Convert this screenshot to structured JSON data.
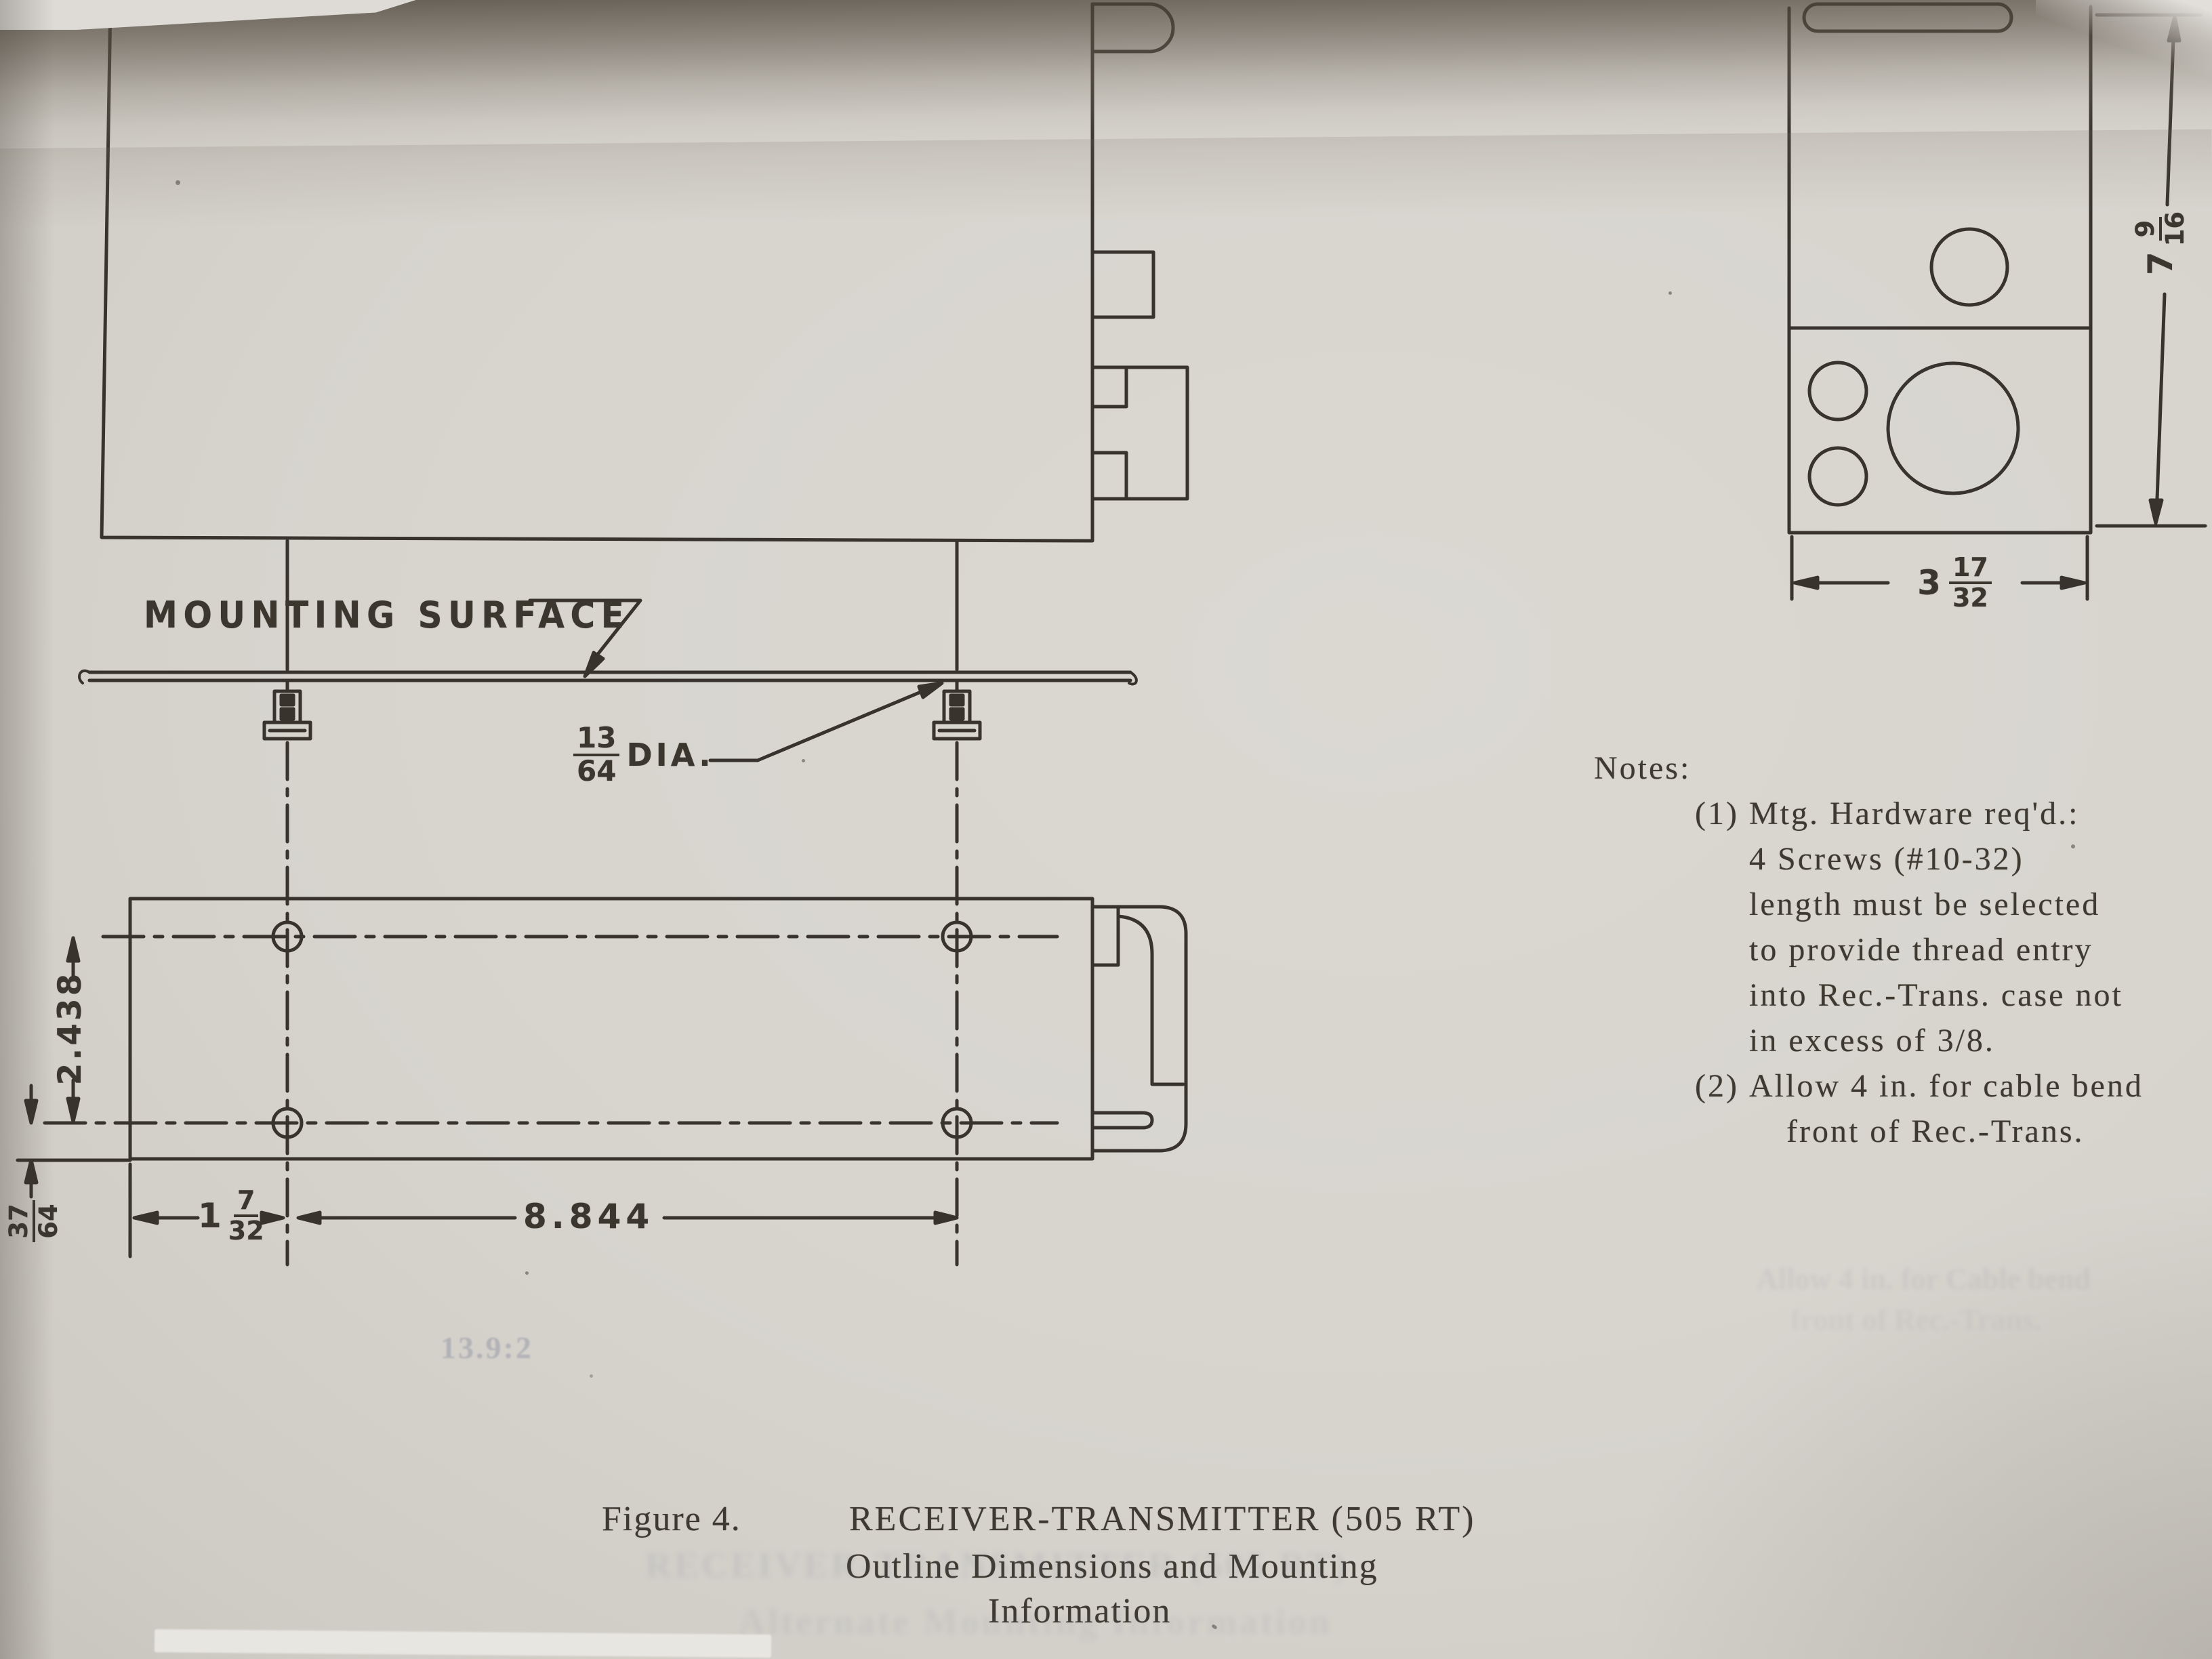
{
  "colors": {
    "paper": "#d7d4ce",
    "ink": "#38342d",
    "shadow": "#5e574c",
    "ghost_ink": "#7d849b"
  },
  "drawing": {
    "mounting_surface_label": "MOUNTING SURFACE",
    "dia": {
      "num": "13",
      "den": "64",
      "suffix": "DIA."
    },
    "dim_hole_row_spacing": "2.438",
    "dim_edge_offset": {
      "num": "37",
      "den": "64"
    },
    "dim_left_hole_offset": {
      "whole": "1",
      "num": "7",
      "den": "32"
    },
    "dim_hole_span": "8.844",
    "front_height": {
      "whole": "7",
      "num": "9",
      "den": "16"
    },
    "front_width": {
      "whole": "3",
      "num": "17",
      "den": "32"
    }
  },
  "notes": {
    "heading": "Notes:",
    "item1_no": "(1)",
    "item1_lines": [
      "Mtg. Hardware req'd.:",
      "4 Screws (#10-32)",
      "length must be selected",
      "to provide thread entry",
      "into Rec.-Trans. case not",
      "in excess of 3/8."
    ],
    "item2_no": "(2)",
    "item2_lines": [
      "Allow 4 in. for cable bend",
      "front of Rec.-Trans."
    ]
  },
  "caption": {
    "figure_label": "Figure 4.",
    "title": "RECEIVER-TRANSMITTER (505 RT)",
    "subtitle_line1": "Outline Dimensions and Mounting",
    "subtitle_line2": "Information"
  },
  "ghost": {
    "page_ref": "13.9:2",
    "caption_echo1": "RECEIVER-TRANSMITTER (505 RT)",
    "caption_echo2": "Alternate Mounting Information",
    "notes_echo1": "Allow 4 in. for Cable bend",
    "notes_echo2": "front of Rec.-Trans."
  }
}
